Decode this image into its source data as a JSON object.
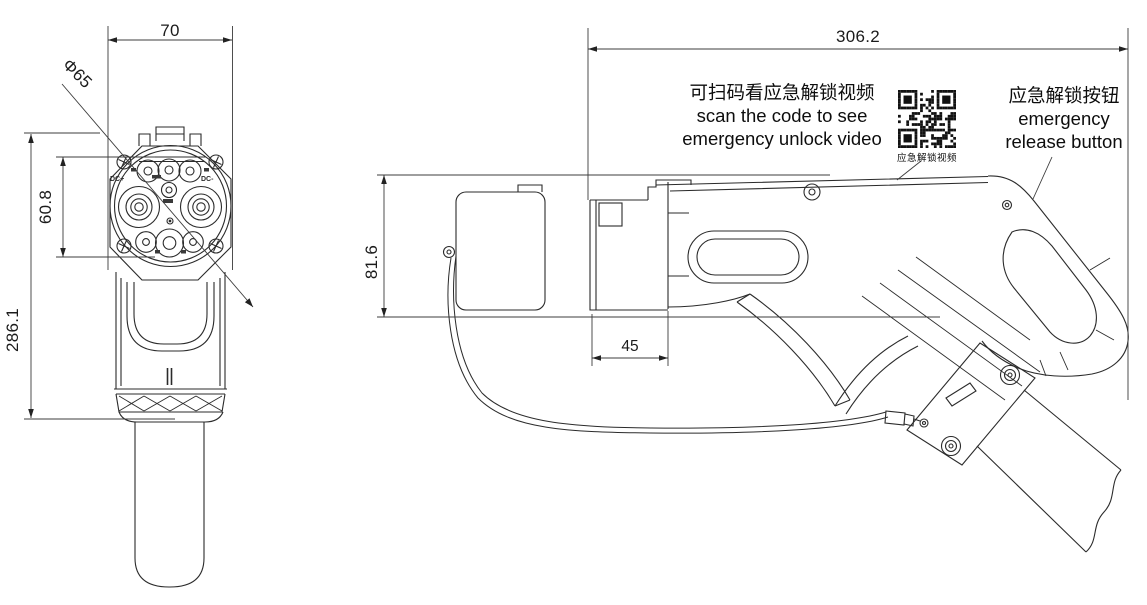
{
  "front_view": {
    "dims": {
      "width": "70",
      "face_diameter": "Φ65",
      "pin_span": "60.8",
      "total_length": "286.1"
    },
    "pin_labels": {
      "dc_plus": "DC+",
      "dc_minus": "DC-"
    }
  },
  "side_view": {
    "dims": {
      "overall_length": "306.2",
      "height": "81.6",
      "nose_length": "45"
    }
  },
  "annotations": {
    "qr_note": {
      "zh": "可扫码看应急解锁视频",
      "en_line1": "scan the code to see",
      "en_line2": "emergency unlock video"
    },
    "qr_caption": "应急解锁视频",
    "release_note": {
      "zh": "应急解锁按钮",
      "en_line1": "emergency",
      "en_line2": "release button"
    }
  },
  "colors": {
    "line": "#2b2b2b",
    "dimension": "#222222",
    "background": "#ffffff"
  }
}
